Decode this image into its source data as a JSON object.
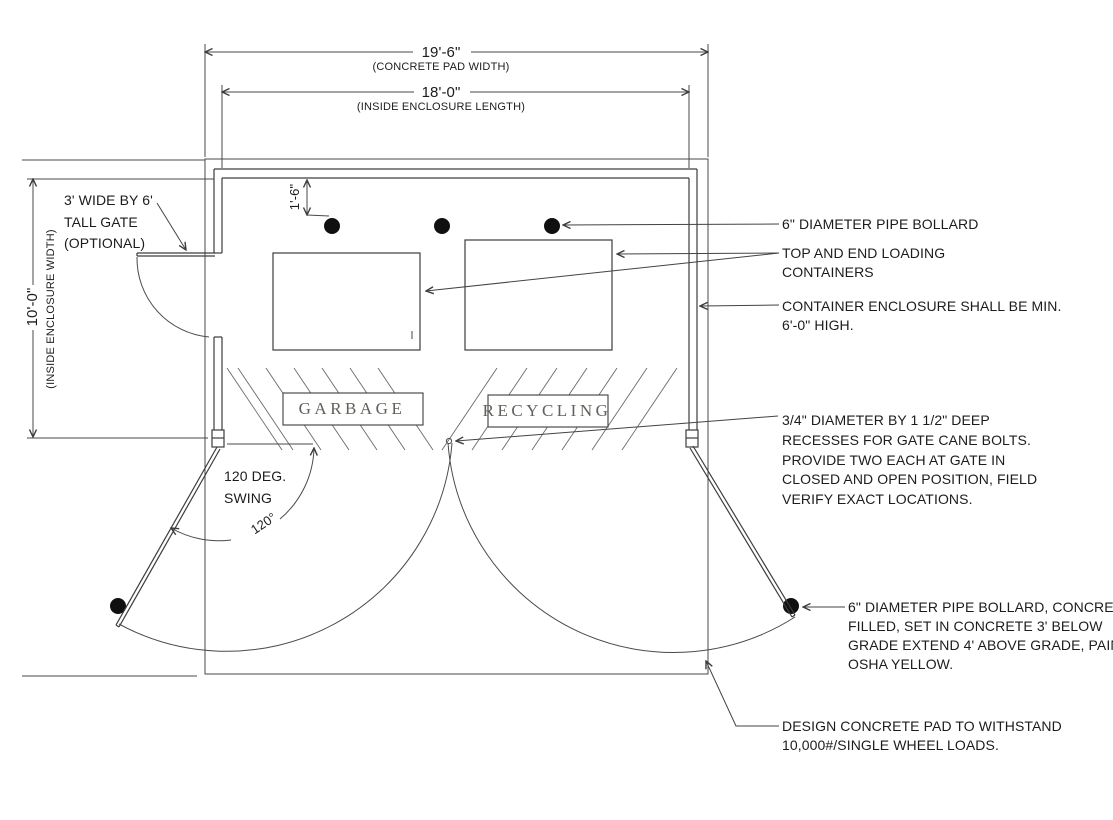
{
  "drawing": {
    "title_implied": "trash and recycling enclosure plan",
    "dimensions": {
      "pad_width": {
        "value": "19'-6\"",
        "label": "(CONCRETE PAD WIDTH)"
      },
      "enclosure_length": {
        "value": "18'-0\"",
        "label": "(INSIDE ENCLOSURE LENGTH)"
      },
      "enclosure_width": {
        "value": "10'-0\"",
        "label": "(INSIDE ENCLOSURE WIDTH)"
      },
      "bollard_offset": {
        "value": "1'-6\""
      }
    },
    "gate_note": {
      "lines": [
        "3' WIDE BY 6'",
        "TALL GATE",
        "(OPTIONAL)"
      ]
    },
    "swing_note": {
      "lines": [
        "120 DEG.",
        "SWING"
      ],
      "angle_label": "120°"
    },
    "container_labels": {
      "garbage": "GARBAGE",
      "recycling": "RECYCLING"
    },
    "annotations": {
      "pipe_bollard": {
        "lines": [
          "6\" DIAMETER PIPE BOLLARD"
        ]
      },
      "loading_containers": {
        "lines": [
          "TOP AND END LOADING",
          "CONTAINERS"
        ]
      },
      "enclosure_height": {
        "lines": [
          "CONTAINER ENCLOSURE SHALL BE MIN.",
          "6'-0\" HIGH."
        ]
      },
      "cane_bolt_recesses": {
        "lines": [
          "3/4\" DIAMETER BY 1 1/2\" DEEP",
          "RECESSES FOR GATE CANE BOLTS.",
          "PROVIDE TWO EACH AT GATE IN",
          "CLOSED AND OPEN POSITION, FIELD",
          "VERIFY EXACT LOCATIONS."
        ]
      },
      "bollard_detail": {
        "lines": [
          "6\" DIAMETER PIPE BOLLARD, CONCRETE",
          "FILLED, SET IN CONCRETE 3' BELOW",
          "GRADE EXTEND 4' ABOVE GRADE, PAINT",
          "OSHA YELLOW."
        ]
      },
      "pad_design": {
        "lines": [
          "DESIGN CONCRETE PAD TO WITHSTAND",
          "10,000#/SINGLE WHEEL LOADS."
        ]
      }
    },
    "colors": {
      "line": "#3d3d3d",
      "text": "#1c1c1c",
      "label_text": "#63605a",
      "background": "#ffffff",
      "bollard_fill": "#101010"
    }
  }
}
